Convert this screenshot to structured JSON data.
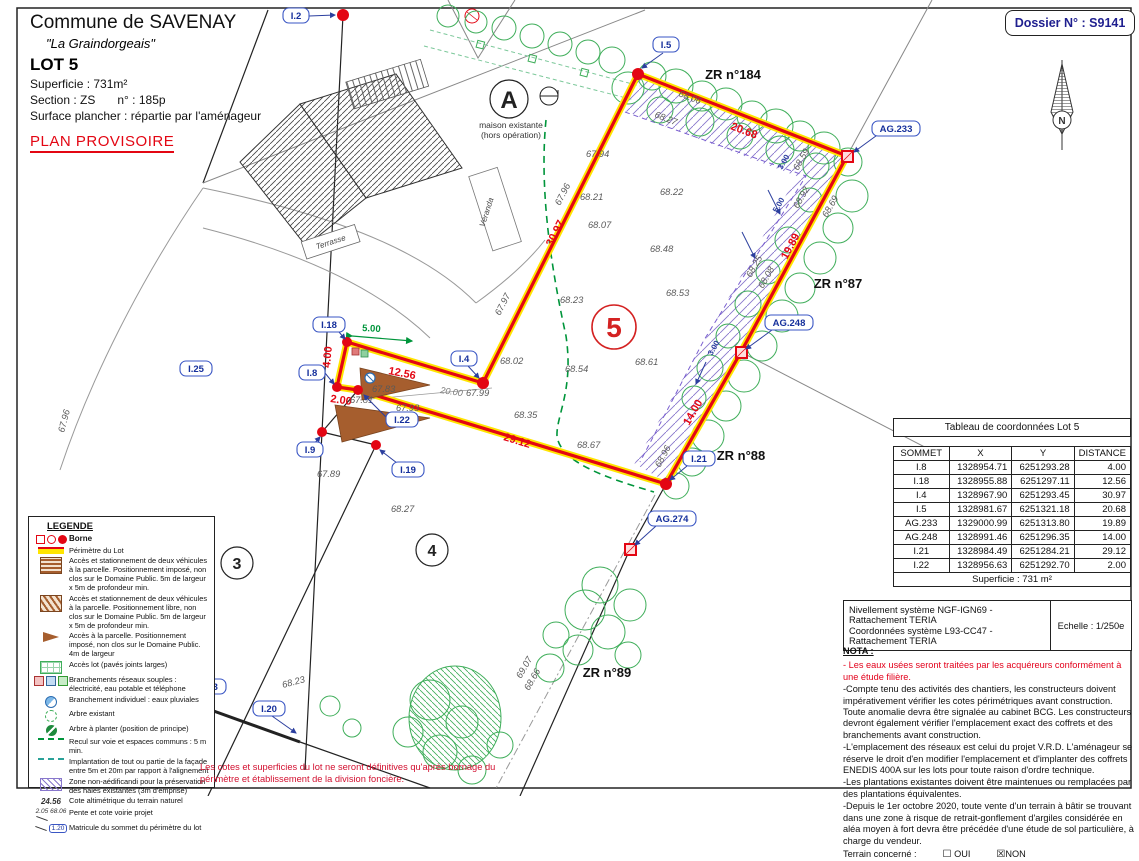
{
  "header": {
    "commune": "Commune de SAVENAY",
    "lieu_dit": "\"La Graindorgeais\"",
    "lot": "LOT 5",
    "superficie": "Superficie :  731m²",
    "section": "Section :  ZS",
    "numero": "n° :  185p",
    "surface_plancher": "Surface plancher : répartie par l'aménageur",
    "plan_status": "PLAN PROVISOIRE"
  },
  "dossier": {
    "label": "Dossier N° : S9141"
  },
  "compass": {
    "n": "N"
  },
  "plan": {
    "zones": {
      "zr184": "ZR n°184",
      "zr87": "ZR n°87",
      "zr88": "ZR n°88",
      "zr89": "ZR n°89"
    },
    "lot_number": "5",
    "parcels": {
      "a": "A",
      "p3": "3",
      "p4": "4"
    },
    "house": {
      "line1": "maison existante",
      "line2": "(hors opération)",
      "terrasse": "Terrasse",
      "veranda": "Véranda"
    },
    "markers": {
      "i2": "I.2",
      "i5": "I.5",
      "i18": "I.18",
      "i8": "I.8",
      "i4": "I.4",
      "i22": "I.22",
      "i9": "I.9",
      "i19": "I.19",
      "i21": "I.21",
      "i20": "I.20",
      "i25": "I.25",
      "ag233": "AG.233",
      "ag248": "AG.248",
      "ag274": "AG.274",
      "g133": "G.133"
    },
    "dims_red": [
      "4.00",
      "2.00",
      "12.56",
      "30.97",
      "20.68",
      "19.89",
      "14.00",
      "29.12"
    ],
    "dim_green": "5.00",
    "dim_gray": "20.00",
    "dims_blue": [
      "3.00",
      "5.00",
      "3.00"
    ],
    "elevations": [
      "67.94",
      "68.21",
      "68.22",
      "68.07",
      "68.48",
      "68.53",
      "68.23",
      "68.02",
      "68.54",
      "68.61",
      "68.35",
      "68.67",
      "68.27",
      "67.89",
      "68.23",
      "67.83",
      "67.99",
      "67.97",
      "67.96",
      "68.06",
      "68.27",
      "68.59",
      "68.92",
      "68.69",
      "68.25",
      "68.08",
      "68.96",
      "69.07",
      "68.66",
      "67.81",
      "67.93",
      "67.96"
    ]
  },
  "coord_table": {
    "title": "Tableau de coordonnées Lot 5",
    "headers": [
      "SOMMET",
      "X",
      "Y",
      "DISTANCE"
    ],
    "rows": [
      [
        "I.8",
        "1328954.71",
        "6251293.28",
        "4.00"
      ],
      [
        "I.18",
        "1328955.88",
        "6251297.11",
        "12.56"
      ],
      [
        "I.4",
        "1328967.90",
        "6251293.45",
        "30.97"
      ],
      [
        "I.5",
        "1328981.67",
        "6251321.18",
        "20.68"
      ],
      [
        "AG.233",
        "1329000.99",
        "6251313.80",
        "19.89"
      ],
      [
        "AG.248",
        "1328991.46",
        "6251296.35",
        "14.00"
      ],
      [
        "I.21",
        "1328984.49",
        "6251284.21",
        "29.12"
      ],
      [
        "I.22",
        "1328956.63",
        "6251292.70",
        "2.00"
      ]
    ],
    "footer": "Superficie : 731 m²"
  },
  "legend": {
    "title": "LEGENDE",
    "items": [
      "Borne",
      "Périmètre du Lot",
      "Accès et stationnement de deux véhicules à la parcelle. Positionnement imposé, non clos sur le Domaine Public. 5m de largeur x 5m de profondeur min.",
      "Accès et stationnement de deux véhicules à la parcelle. Positionnement libre, non clos sur le Domaine Public. 5m de largeur x 5m de profondeur min.",
      "Accès à la parcelle. Positionnement imposé, non clos sur le Domaine Public. 4m de largeur",
      "Accès lot (pavés joints larges)",
      "Branchements réseaux souples : électricité, eau potable et téléphone",
      "Branchement individuel : eaux pluviales",
      "Arbre existant",
      "Arbre à planter (position de principe)",
      "Recul sur voie et espaces communs : 5 m min.",
      "Implantation de tout ou partie de la façade entre 5m et 20m par rapport à l'alignement",
      "Zone non-aédificandi pour la préservation des haies existantes (3m d'emprise)",
      "Cote altimétrique du terrain naturel",
      "Pente et cote voirie projet",
      "Matricule du sommet du périmètre du lot"
    ],
    "samples": {
      "cote": "24.56",
      "pente_val": "2.05",
      "pente_cote": "68.06",
      "matricule": "1.20"
    }
  },
  "survey": {
    "line1": "Nivellement système NGF-IGN69 - Rattachement TERIA",
    "line2": "Coordonnées système L93-CC47  - Rattachement TERIA",
    "echelle": "Echelle : 1/250e"
  },
  "nota": {
    "title": "NOTA :",
    "red_item": "- Les eaux usées seront traitées par les acquéreurs conformément à une étude filière.",
    "items": [
      "-Compte tenu des activités des chantiers, les constructeurs doivent impérativement vérifier les cotes périmétriques avant construction. Toute anomalie devra être signalée au cabinet BCG. Les constructeurs devront également vérifier l'emplacement exact des coffrets et des branchements avant construction.",
      "-L'emplacement des réseaux est celui du projet V.R.D. L'aménageur se réserve le droit d'en modifier l'emplacement et d'implanter des coffrets ENEDIS 400A sur les lots pour toute raison d'ordre technique.",
      "-Les plantations existantes doivent être maintenues ou remplacées par des plantations équivalentes.",
      "-Depuis le 1er octobre 2020, toute vente d'un terrain à bâtir se trouvant dans une zone à risque de retrait-gonflement d'argiles considérée en aléa moyen à fort devra être précédée d'une étude de sol particulière, à charge du vendeur."
    ],
    "terrain_label": "Terrain concerné :",
    "oui": "OUI",
    "non": "NON"
  },
  "disclaimer": "Les cotes et superficies du lot ne seront définitives qu'après bornage du périmètre et établissement de la division foncière.",
  "icons": {
    "box_empty": "☐",
    "box_checked": "☒"
  },
  "colors": {
    "lot_red": "#e30613",
    "lot_yellow": "#ffe500",
    "marker_blue": "#16309c",
    "tree_green": "#3fae5a",
    "hatch_purple": "#8877cc",
    "recul_green": "#00953b",
    "access_brown": "#a65e2e",
    "nota_red": "#e3001b",
    "dossier_navy": "#1f1f8f"
  }
}
